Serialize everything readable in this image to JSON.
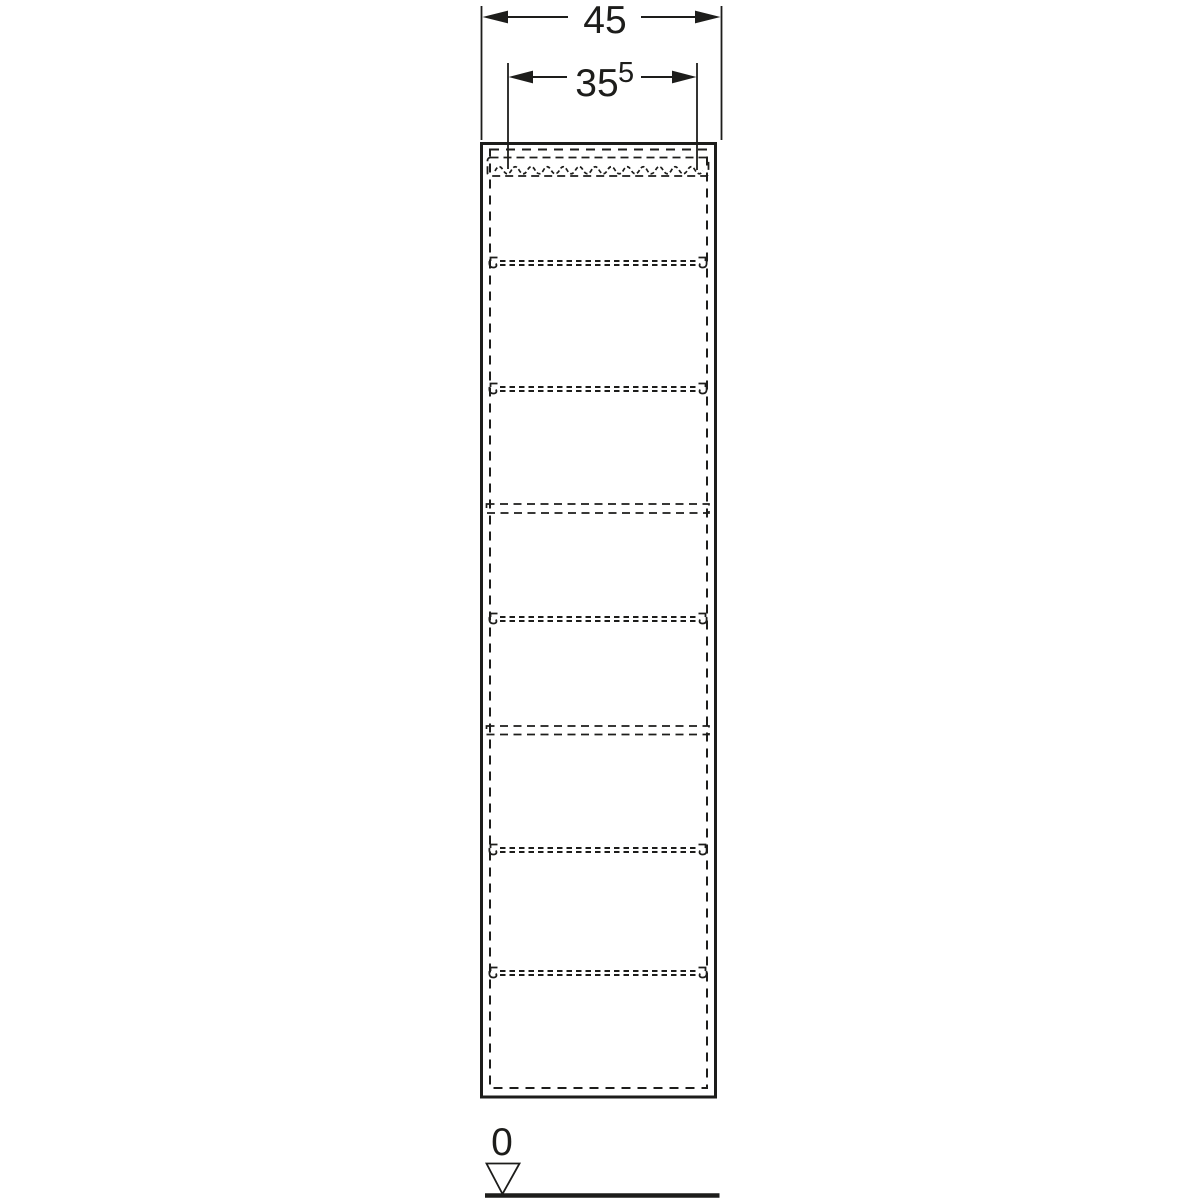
{
  "page": {
    "background_color": "#ffffff"
  },
  "drawing": {
    "kind": "furniture-technical-drawing-front-elevation",
    "line_color": "#1d1d1b",
    "dimension_top": {
      "label": "45"
    },
    "dimension_inner": {
      "label": "35",
      "superscript": "5"
    },
    "datum": {
      "label": "0"
    },
    "adjustable_shelf_count": 5,
    "fixed_shelf_count": 2
  }
}
